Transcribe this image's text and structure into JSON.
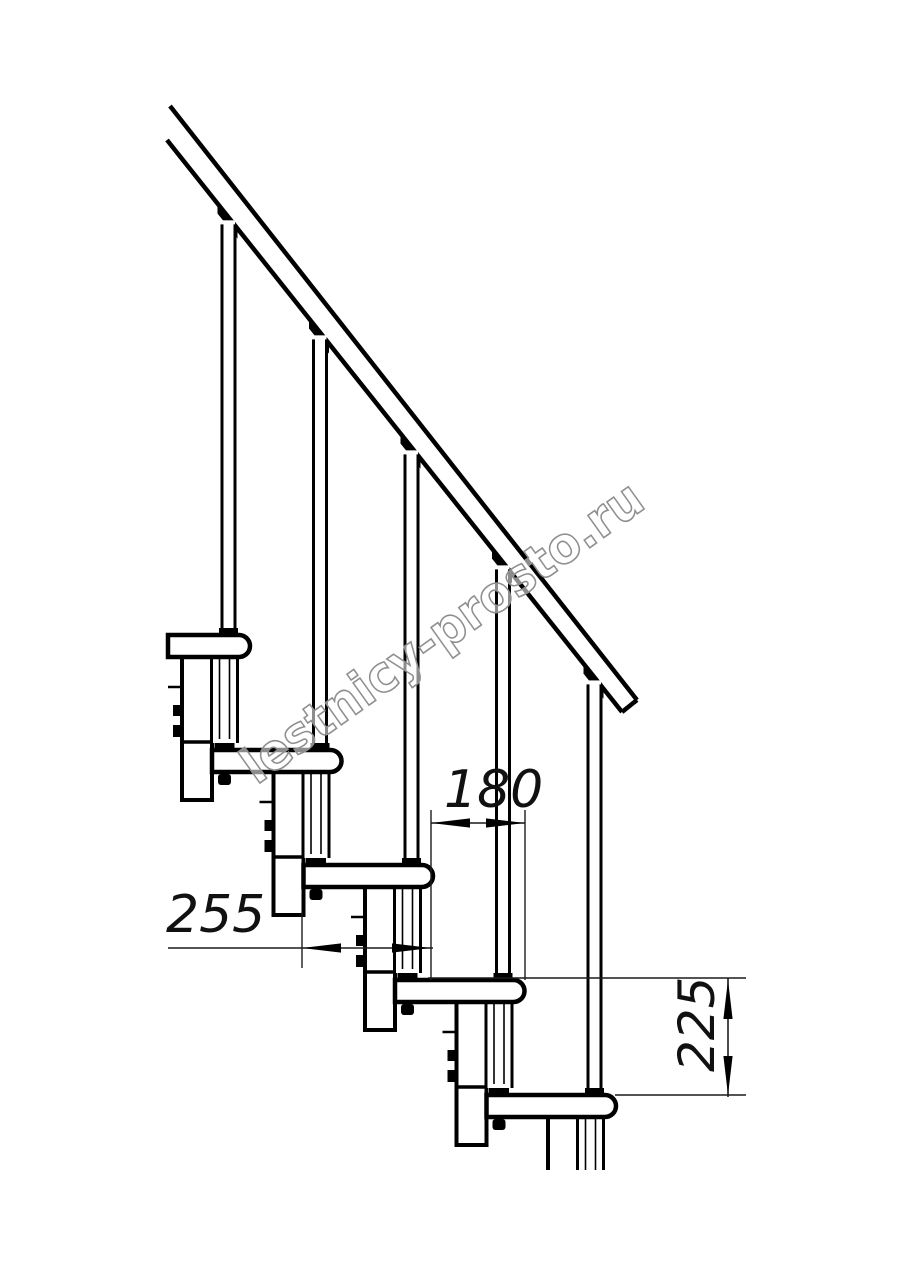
{
  "drawing": {
    "type": "staircase-side-view-detail",
    "steps_visible": 5,
    "line_color": "#000000",
    "thin_line_color": "#1c1c1c",
    "background": "#ffffff"
  },
  "dimensions": {
    "going": {
      "label": "180"
    },
    "depth": {
      "label": "255"
    },
    "rise": {
      "label": "225"
    }
  },
  "watermark": {
    "text": "lestnicy-prosto.ru",
    "color": "#8f8f8f"
  }
}
